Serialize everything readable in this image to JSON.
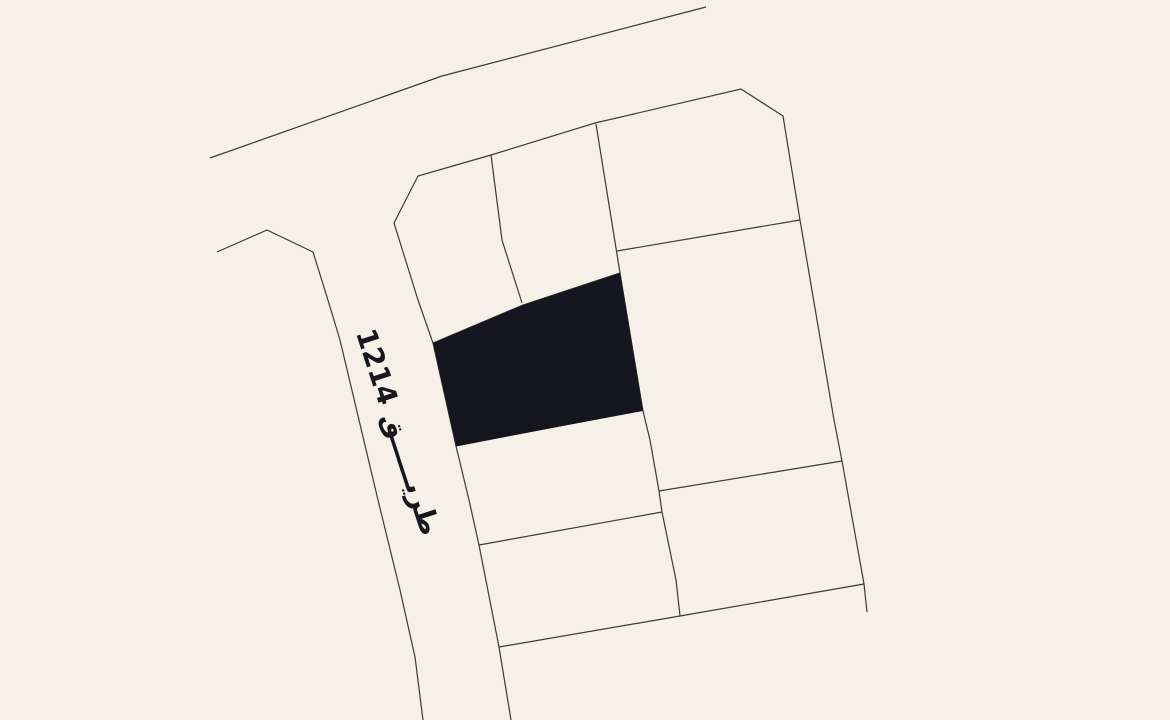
{
  "map": {
    "background_color": "#f5f0e8",
    "line_color": "#3c3a38",
    "line_width": 1.2,
    "road_label": {
      "text": "طريـــــق 1214",
      "color": "#17181d",
      "rotation_deg": 72,
      "center_x": 398,
      "center_y": 432,
      "font_size": 28
    },
    "highlighted_parcel": {
      "fill": "#14151e",
      "points": "433,343 523,305 620,273 643,411 456,446"
    },
    "polylines": [
      {
        "name": "north-road-edge",
        "points": "210,158 442,76 706,7"
      },
      {
        "name": "west-road-edge",
        "points": "217,252 267,230 313,252 327,297 340,340 378,500 400,590 415,657 423,720"
      },
      {
        "name": "parcel-block-outline",
        "points": "511,720 499,647 479,545 469,500 456,446 433,343 418,300 394,223 418,176 491,155 595,123 741,89 783,116 800,220 834,420 842,461 864,584 867,612"
      },
      {
        "name": "middle-right-column-boundary",
        "points": "596,124 620,273 643,411 650,440 659,491 662,512 676,580 680,616"
      },
      {
        "name": "top-middle-divider",
        "points": "491,155 502,240 522,303"
      },
      {
        "name": "selected-parcel-top-edge",
        "points": "433,343 523,305 620,273"
      },
      {
        "name": "selected-parcel-bottom-edge",
        "points": "456,446 641,410"
      },
      {
        "name": "middle-column-divider",
        "points": "479,545 662,512"
      },
      {
        "name": "lower-cross-divider",
        "points": "499,647 680,616 864,584"
      },
      {
        "name": "right-column-divider-1",
        "points": "617,251 800,220"
      },
      {
        "name": "right-column-divider-2",
        "points": "659,491 842,461"
      }
    ]
  }
}
